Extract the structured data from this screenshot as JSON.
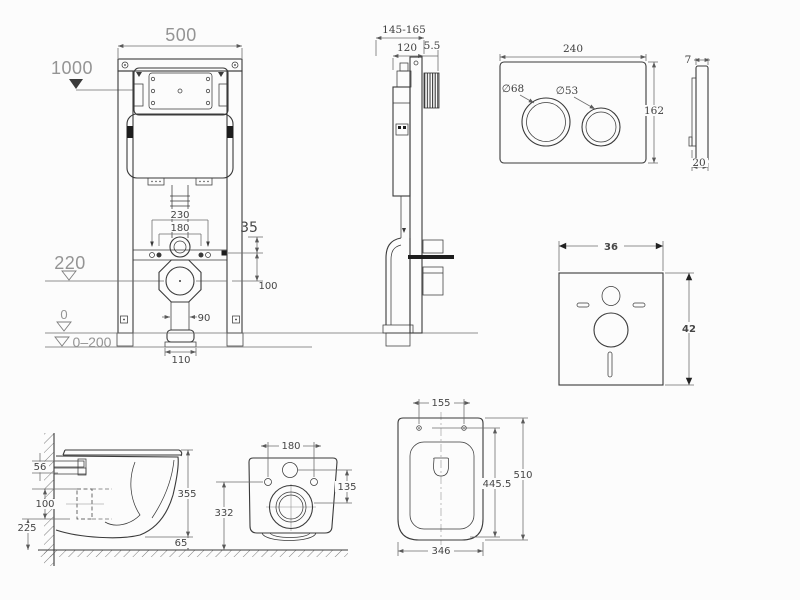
{
  "colors": {
    "background": "#fcfcfc",
    "object_line": "#3a3a3a",
    "dimension_line": "#6e6e6e",
    "dimension_text": "#464646",
    "reference_text": "#949494"
  },
  "views": {
    "frame_front": {
      "dims": {
        "width": "500",
        "wall_ref_height": "1000",
        "pipe_span": "230",
        "bolt_span": "180",
        "offset": "35",
        "bolt_to_drain": "100",
        "drain_height": "220",
        "pipe_width": "90",
        "outlet_width": "110",
        "floor_zero": "0",
        "floor_adjust": "0–200"
      }
    },
    "frame_side": {
      "dims": {
        "depth_range": "145-165",
        "body_depth": "120",
        "plate_gap": "5.5"
      }
    },
    "plate_front": {
      "dims": {
        "width": "240",
        "height": "162",
        "big_button": "∅68",
        "small_button": "∅53"
      }
    },
    "plate_side": {
      "dims": {
        "thickness": "7",
        "total_depth": "20"
      }
    },
    "sound_pad": {
      "dims": {
        "width": "36",
        "height": "42"
      }
    },
    "toilet_side": {
      "dims": {
        "fixing_gap": "56",
        "drain_offset": "100",
        "drain_to_floor": "225",
        "body_height": "355",
        "floor_clearance": "65"
      }
    },
    "toilet_rear": {
      "dims": {
        "bolt_span": "180",
        "inlet_to_drain": "135",
        "drain_height": "332"
      }
    },
    "toilet_top": {
      "dims": {
        "bolt_span": "155",
        "inner_depth": "445.5",
        "total_depth": "510",
        "width": "346"
      }
    }
  }
}
